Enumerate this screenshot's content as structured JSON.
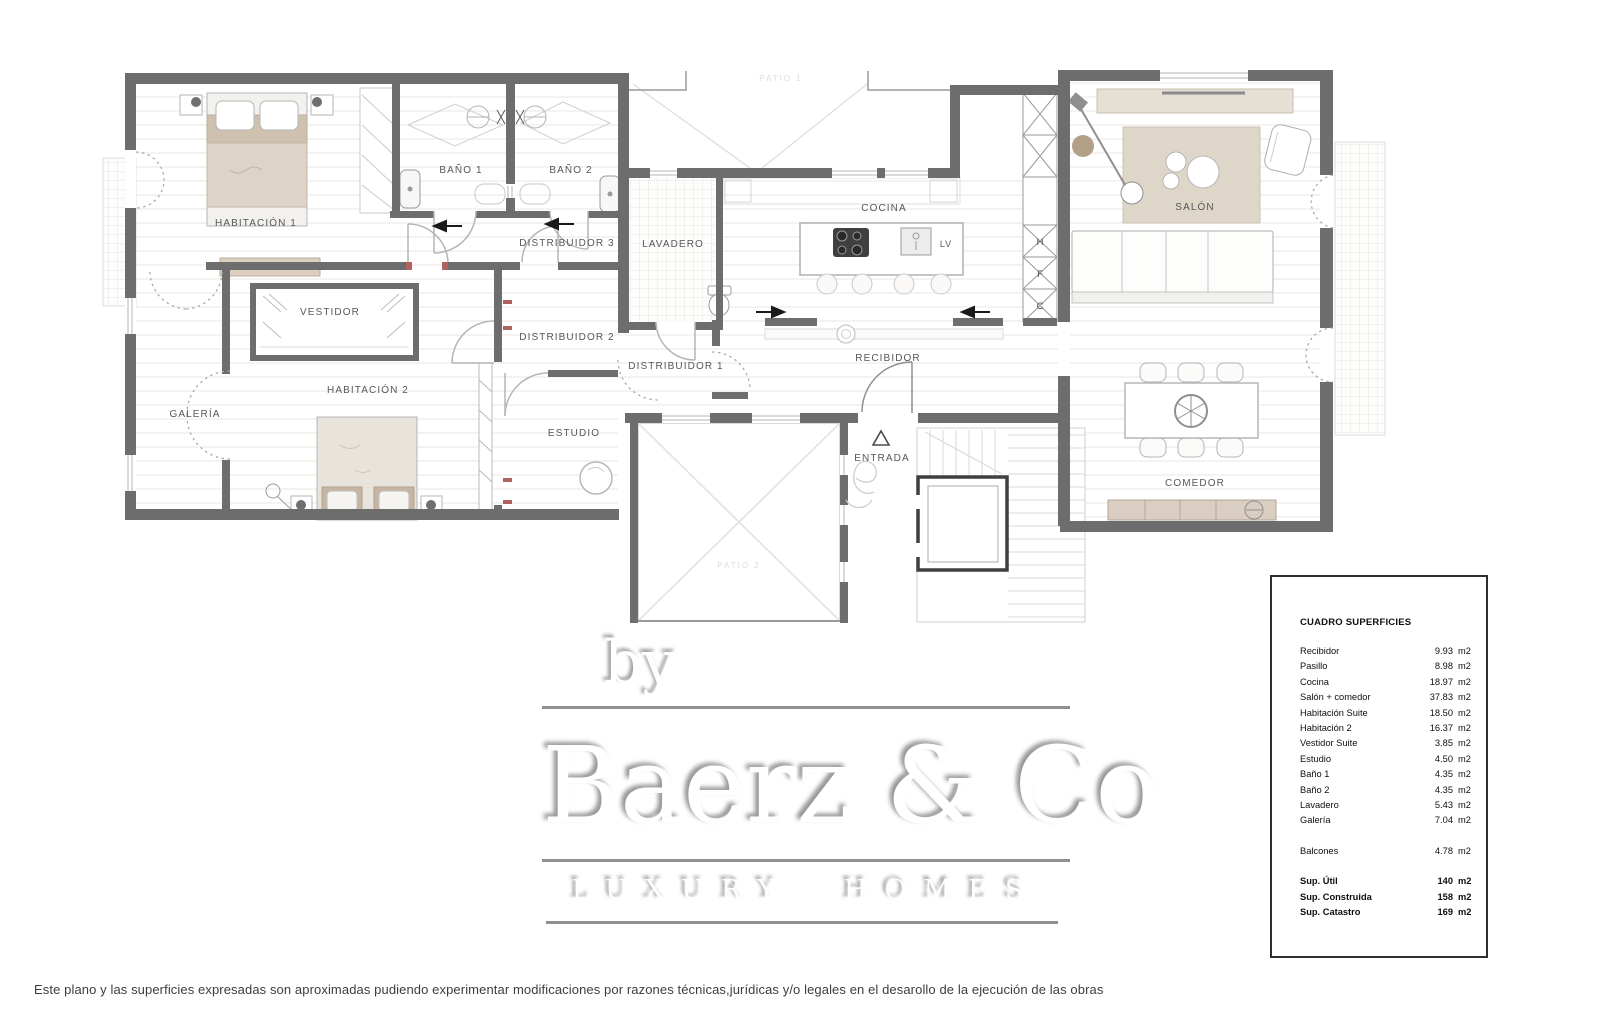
{
  "plan": {
    "labels": {
      "habitacion1": "HABITACIÓN 1",
      "bano1": "BAÑO 1",
      "bano2": "BAÑO 2",
      "distribuidor3": "DISTRIBUIDOR 3",
      "lavadero": "LAVADERO",
      "cocina": "COCINA",
      "salon": "SALÓN",
      "vestidor": "VESTIDOR",
      "distribuidor2": "DISTRIBUIDOR 2",
      "habitacion2": "HABITACIÓN 2",
      "galeria": "GALERÍA",
      "estudio": "ESTUDIO",
      "distribuidor1": "DISTRIBUIDOR 1",
      "recibidor": "RECIBIDOR",
      "entrada": "ENTRADA",
      "comedor": "COMEDOR",
      "lv": "LV",
      "patio_top": "PATIO 1",
      "patio_bottom": "PATIO 2",
      "closet_h": "H",
      "closet_f": "F",
      "closet_c": "C"
    }
  },
  "watermark": {
    "by": "by",
    "brand": "Baerz & Co",
    "tagline": "LUXURY HOMES"
  },
  "surfaces": {
    "title": "CUADRO SUPERFICIES",
    "rows": [
      {
        "label": "Recibidor",
        "value": "9.93",
        "unit": "m2"
      },
      {
        "label": "Pasillo",
        "value": "8.98",
        "unit": "m2"
      },
      {
        "label": "Cocina",
        "value": "18.97",
        "unit": "m2"
      },
      {
        "label": "Salón + comedor",
        "value": "37.83",
        "unit": "m2"
      },
      {
        "label": "Habitación Suite",
        "value": "18.50",
        "unit": "m2"
      },
      {
        "label": "Habitación 2",
        "value": "16.37",
        "unit": "m2"
      },
      {
        "label": "Vestidor Suite",
        "value": "3.85",
        "unit": "m2"
      },
      {
        "label": "Estudio",
        "value": "4.50",
        "unit": "m2"
      },
      {
        "label": "Baño 1",
        "value": "4.35",
        "unit": "m2"
      },
      {
        "label": "Baño 2",
        "value": "4.35",
        "unit": "m2"
      },
      {
        "label": "Lavadero",
        "value": "5.43",
        "unit": "m2"
      },
      {
        "label": "Galería",
        "value": "7.04",
        "unit": "m2"
      },
      {
        "label": "Balcones",
        "value": "4.78",
        "unit": "m2"
      }
    ],
    "totals": [
      {
        "label": "Sup. Útil",
        "value": "140",
        "unit": "m2"
      },
      {
        "label": "Sup. Construida",
        "value": "158",
        "unit": "m2"
      },
      {
        "label": "Sup. Catastro",
        "value": "169",
        "unit": "m2"
      }
    ]
  },
  "disclaimer": "Este plano y las superficies expresadas son aproximadas pudiendo experimentar modificaciones por razones técnicas,jurídicas y/o legales en el desarollo de la ejecución de las obras"
}
